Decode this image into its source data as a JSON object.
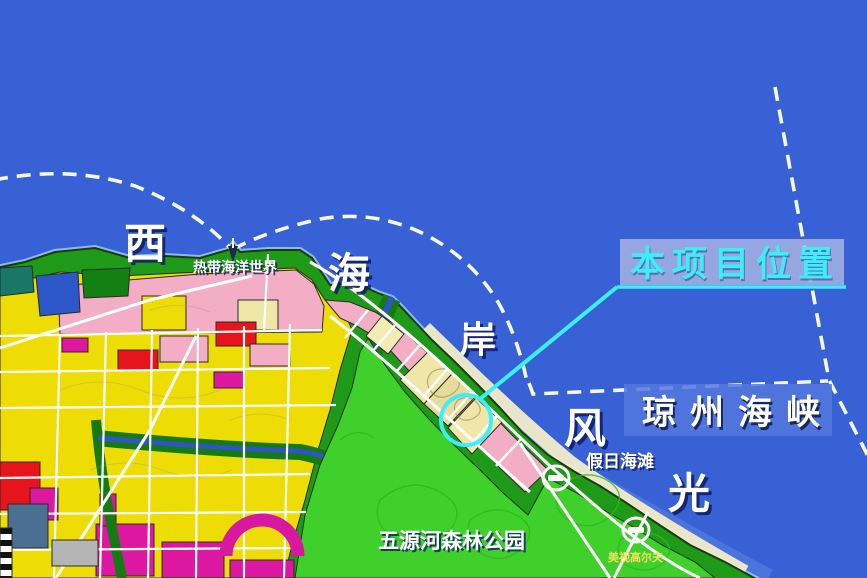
{
  "map": {
    "coast_chars": {
      "xi": "西",
      "hai": "海",
      "an": "岸",
      "feng": "风",
      "guang": "光"
    },
    "strait": {
      "label": "琼州海峡"
    },
    "project": {
      "label": "本项目位置"
    },
    "pois": {
      "ocean_world": "热带海洋世界",
      "holiday_beach": "假日海滩",
      "forest_park": "五源河森林公园",
      "golf_course": "美视高尔夫"
    },
    "colors": {
      "sea": "#3761d4",
      "accent_cyan": "#3ceef8",
      "land_green": "#1f9a18",
      "park_green": "#3fd02c",
      "parcel_yellow": "#eedd05",
      "parcel_pink": "#f3aec6",
      "parcel_pale": "#efe6a8",
      "parcel_red": "#e8141c",
      "parcel_magenta": "#dd18a0",
      "river_blue": "#2f55c0",
      "beach_sand": "#f1ecca",
      "road_white": "#ffffff",
      "strait_box": "#5478dc",
      "project_box": "#aeb8e4",
      "dashed_line": "#f5f7fb"
    }
  }
}
